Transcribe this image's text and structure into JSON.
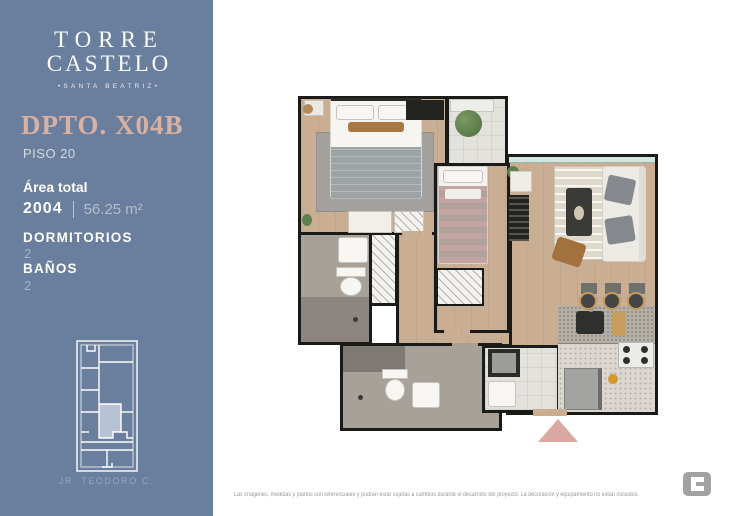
{
  "brand": {
    "name_line1": "TORRE",
    "name_line2": "CASTELO",
    "subtitle": "•SANTA BEATRIZ•"
  },
  "unit": {
    "title": "DPTO. X04B",
    "floor": "PISO 20"
  },
  "details": {
    "area_label": "Área total",
    "unit_number": "2004",
    "area_value": "56.25 m²",
    "bedrooms_label": "DORMITORIOS",
    "bedrooms_value": "2",
    "bathrooms_label": "BAÑOS",
    "bathrooms_value": "2"
  },
  "keyplan": {
    "street": "JR. TEODORO C."
  },
  "footer": {
    "disclaimer": "Las imágenes, medidas y planos son referenciales y podrán estar sujetas a cambios durante el desarrollo del proyecto. La decoración y equipamiento no están incluidos."
  },
  "colors": {
    "sidebar_bg": "#6a7e9e",
    "title_accent": "#d7b1a2",
    "entrance_marker": "#d9a9a2",
    "keyplan_highlight": "#b7c3d4",
    "wall": "#1a1a18"
  }
}
